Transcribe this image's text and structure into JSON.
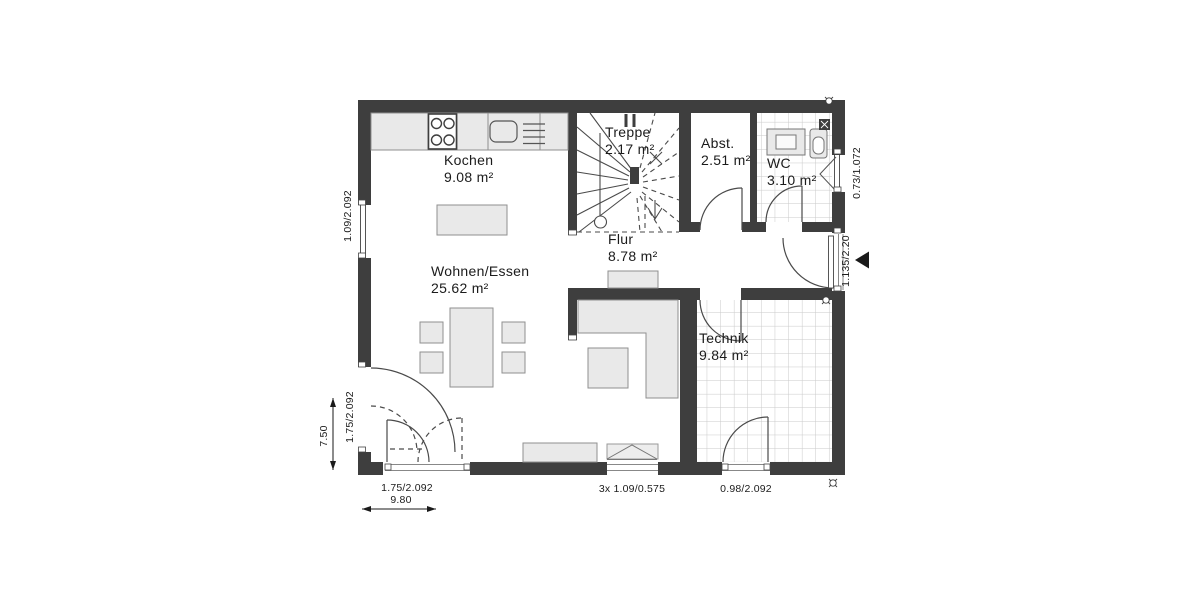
{
  "plan_type": "floor-plan",
  "rooms": {
    "kochen": {
      "name": "Kochen",
      "area": "9.08 m²"
    },
    "treppe": {
      "name": "Treppe",
      "area": "2.17 m²"
    },
    "abstellraum": {
      "name": "Abst.",
      "area": "2.51 m²"
    },
    "wc": {
      "name": "WC",
      "area": "3.10 m²"
    },
    "flur": {
      "name": "Flur",
      "area": "8.78 m²"
    },
    "wohnen_essen": {
      "name": "Wohnen/Essen",
      "area": "25.62 m²"
    },
    "technik": {
      "name": "Technik",
      "area": "9.84 m²"
    }
  },
  "dimensions": {
    "left_window": "1.09/2.092",
    "left_door": "1.75/2.092",
    "overall_depth": "7.50",
    "bottom_left_door": "1.75/2.092",
    "overall_width": "9.80",
    "bottom_window": "3x 1.09/0.575",
    "technik_door": "0.98/2.092",
    "wc_window": "0.73/1.072",
    "entrance_door": "1.135/2.20"
  },
  "colors": {
    "wall": "#3e3e3e",
    "furniture_fill": "#e9e9e9",
    "furniture_stroke": "#8f8f8f",
    "tile_line": "#c9c9c9",
    "text": "#1b1b1b"
  }
}
